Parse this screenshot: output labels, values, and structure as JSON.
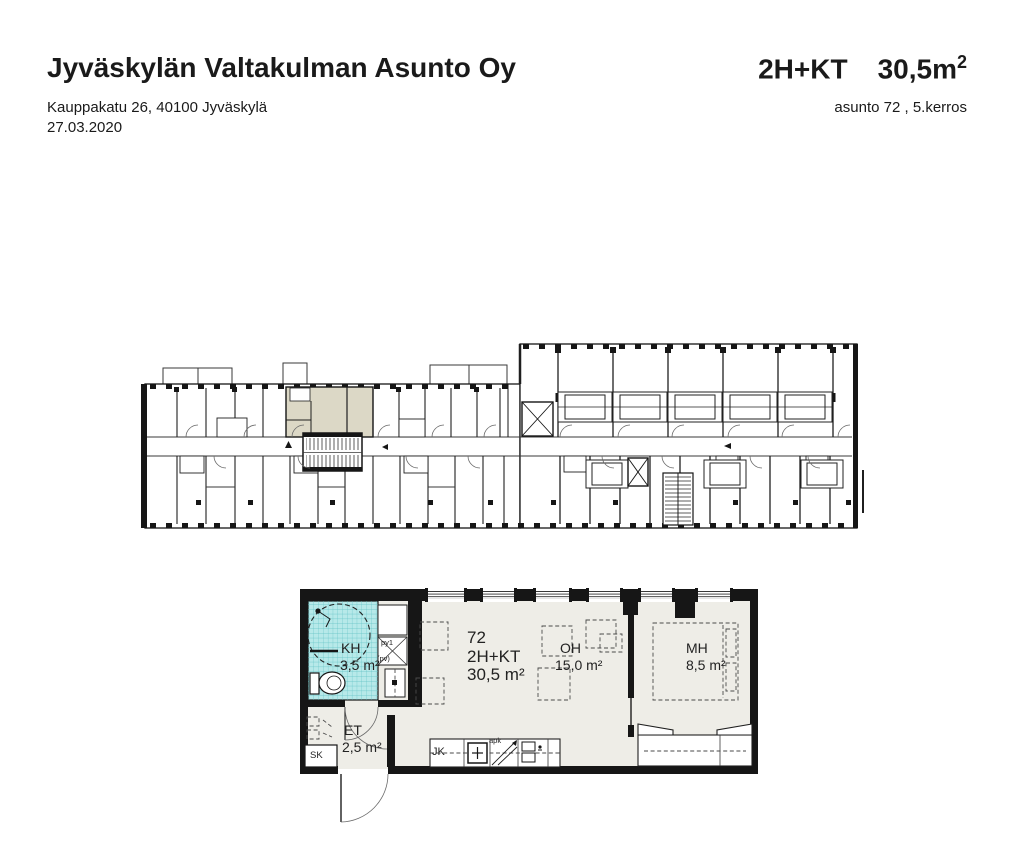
{
  "header": {
    "title": "Jyväskylän Valtakulman Asunto Oy",
    "address": "Kauppakatu 26, 40100 Jyväskylä",
    "date": "27.03.2020",
    "apartment_type": "2H+KT",
    "apartment_area_value": "30,5m",
    "apartment_area_sup": "2",
    "apartment_info": "asunto 72 , 5.kerros"
  },
  "detail_plan": {
    "apartment_number": "72",
    "apartment_type": "2H+KT",
    "apartment_area": "30,5 m²",
    "rooms": {
      "kh": {
        "name": "KH",
        "area": "3,5 m²"
      },
      "et": {
        "name": "ET",
        "area": "2,5 m²"
      },
      "oh": {
        "name": "OH",
        "area": "15,0 m²"
      },
      "mh": {
        "name": "MH",
        "area": "8,5 m²"
      }
    },
    "fixtures": {
      "fridge": "JK",
      "cleaning_closet": "SK",
      "washer_closet": "py1",
      "washer_note": "(pv)",
      "dishwasher": "apk"
    }
  },
  "colors": {
    "highlighted_unit": "#dcd8c6",
    "bathroom_tile": "#b7e9e9",
    "apartment_floor": "#eeede7",
    "wall": "#161616"
  }
}
